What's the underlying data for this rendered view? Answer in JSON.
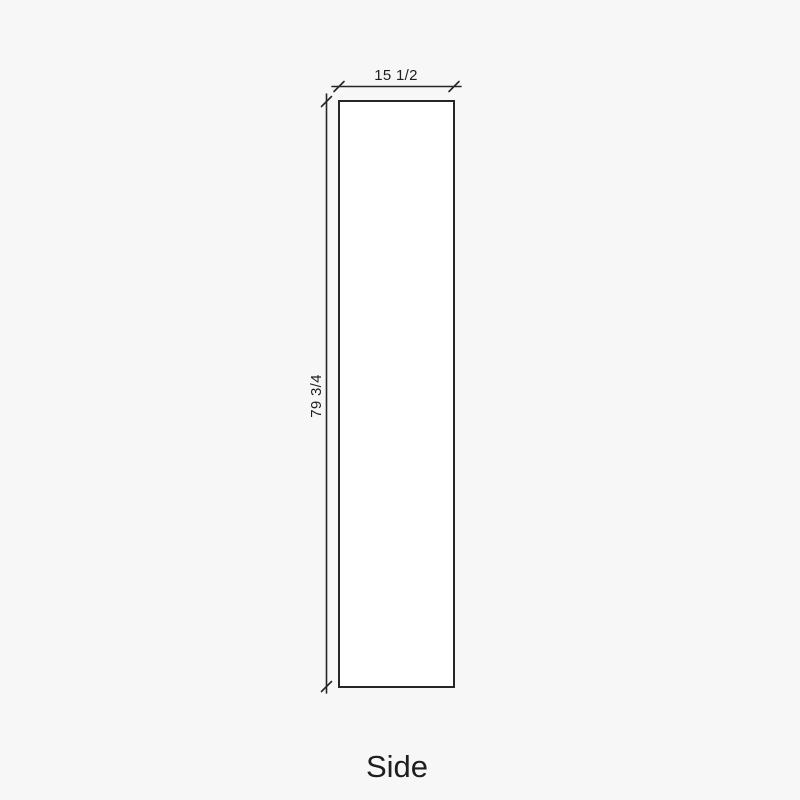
{
  "diagram": {
    "view_name": "Side",
    "part_label": "Side",
    "width_dimension": "15 1/2",
    "height_dimension": "79 3/4"
  },
  "colors": {
    "line": "#262626",
    "text": "#1e1e1e",
    "background": "#f7f7f7",
    "panel-fill": "#ffffff"
  }
}
